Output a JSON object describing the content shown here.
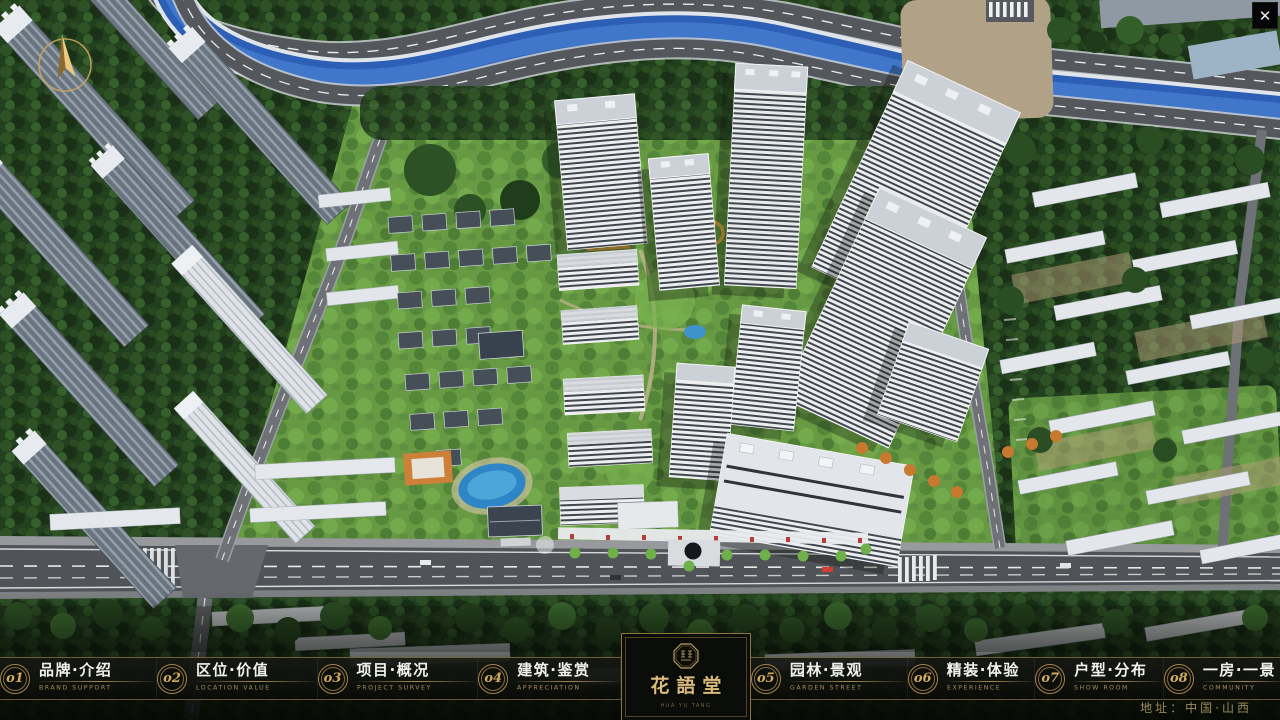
{
  "icons": {
    "close": "✕"
  },
  "nav": {
    "items": [
      {
        "num": "o1",
        "label": "品牌·介绍",
        "sub": "BRAND SUPPORT"
      },
      {
        "num": "o2",
        "label": "区位·价值",
        "sub": "LOCATION VALUE"
      },
      {
        "num": "o3",
        "label": "项目·概况",
        "sub": "PROJECT SURVEY"
      },
      {
        "num": "o4",
        "label": "建筑·鉴赏",
        "sub": "APPRECIATION"
      },
      {
        "num": "o5",
        "label": "园林·景观",
        "sub": "GARDEN STREET"
      },
      {
        "num": "o6",
        "label": "精装·体验",
        "sub": "EXPERIENCE"
      },
      {
        "num": "o7",
        "label": "户型·分布",
        "sub": "SHOW ROOM"
      },
      {
        "num": "o8",
        "label": "一房·一景",
        "sub": "COMMUNITY"
      }
    ]
  },
  "brand": {
    "logo_text": "花語堂",
    "logo_sub": "HUA YU TANG"
  },
  "footer": {
    "address": "地址：中国·山西"
  },
  "colors": {
    "gold": "#c2a05e",
    "dark_panel": "#0b0d0a",
    "accent_red": "#b23f35",
    "river_blue": "#2c5fb5"
  }
}
